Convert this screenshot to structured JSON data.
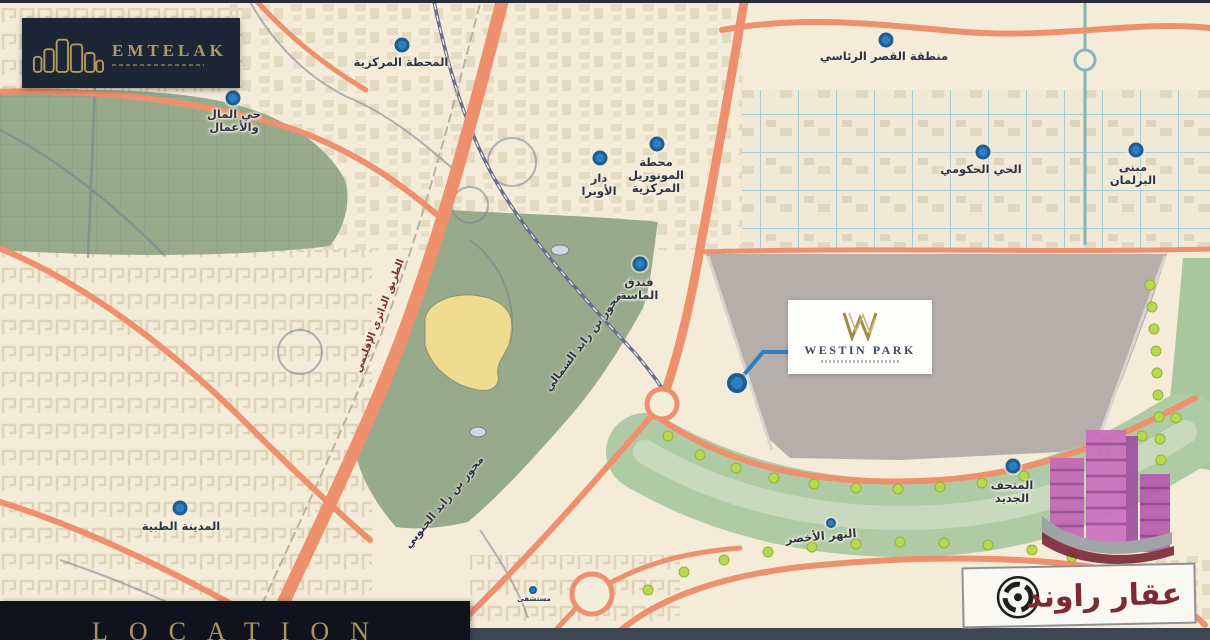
{
  "branding": {
    "developer_logo": "EMTELAK",
    "agency_watermark": "عقار راوند"
  },
  "footer": {
    "location_banner": "LOCATION"
  },
  "project_card": {
    "name": "WESTIN PARK"
  },
  "map": {
    "colors": {
      "cream_background": "#f4ecd9",
      "road_orange": "#ee8f6e",
      "park_green": "#97aa8c",
      "green_river": "#aecba6",
      "district_plot_gray": "#b5aeab",
      "marker_blue": "#2e7fc2",
      "gold": "#b49a5c",
      "navy_dark": "#1d2636",
      "maroon_text": "#7c2f2f",
      "teal_grid": "#a6ced2",
      "tree_lime": "#b7d84f"
    },
    "project_marker": {
      "x": 737,
      "y": 383
    },
    "landmarks": [
      {
        "label": "المحطة المركزية",
        "x": 401,
        "y": 56,
        "dot": [
          402,
          45
        ]
      },
      {
        "label": "حي المال\nوالأعمال",
        "x": 234,
        "y": 108,
        "dot": [
          233,
          98
        ]
      },
      {
        "label": "دار\nالأوبرا",
        "x": 599,
        "y": 172,
        "dot": [
          600,
          158
        ]
      },
      {
        "label": "محطة\nالمونوريل\nالمركزية",
        "x": 656,
        "y": 156,
        "dot": [
          657,
          144
        ]
      },
      {
        "label": "منطقة القصر الرئاسي",
        "x": 884,
        "y": 50,
        "dot": [
          886,
          40
        ]
      },
      {
        "label": "الحي الحكومي",
        "x": 981,
        "y": 163,
        "dot": [
          983,
          152
        ]
      },
      {
        "label": "مبنى البرلمان",
        "x": 1133,
        "y": 161,
        "dot": [
          1136,
          150
        ]
      },
      {
        "label": "فندق\nالماسة",
        "x": 639,
        "y": 276,
        "dot": [
          640,
          264
        ]
      },
      {
        "label": "المتحف\nالجديد",
        "x": 1012,
        "y": 479,
        "dot": [
          1013,
          466
        ]
      },
      {
        "label": "النهر الأخضر",
        "x": 821,
        "y": 530,
        "dot": [
          831,
          523
        ],
        "dot_size": "small",
        "angle": -5
      },
      {
        "label": "المدينة الطبية",
        "x": 181,
        "y": 520,
        "dot": [
          180,
          508
        ]
      },
      {
        "label": "مستشفى",
        "x": 534,
        "y": 596,
        "dot": [
          533,
          590
        ],
        "dot_size": "tiny",
        "size": 7
      }
    ],
    "road_labels": [
      {
        "label": "محور بن زايد الشمالي",
        "x": 583,
        "y": 342,
        "angle": -53,
        "color": "#2b3446"
      },
      {
        "label": "محور بن زايد الجنوبي",
        "x": 444,
        "y": 502,
        "angle": -50,
        "color": "#2b3446"
      },
      {
        "label": "الطريق الدائري الإقليمي",
        "x": 380,
        "y": 316,
        "angle": -69,
        "color": "#7c2f2f",
        "size": 10
      }
    ]
  }
}
